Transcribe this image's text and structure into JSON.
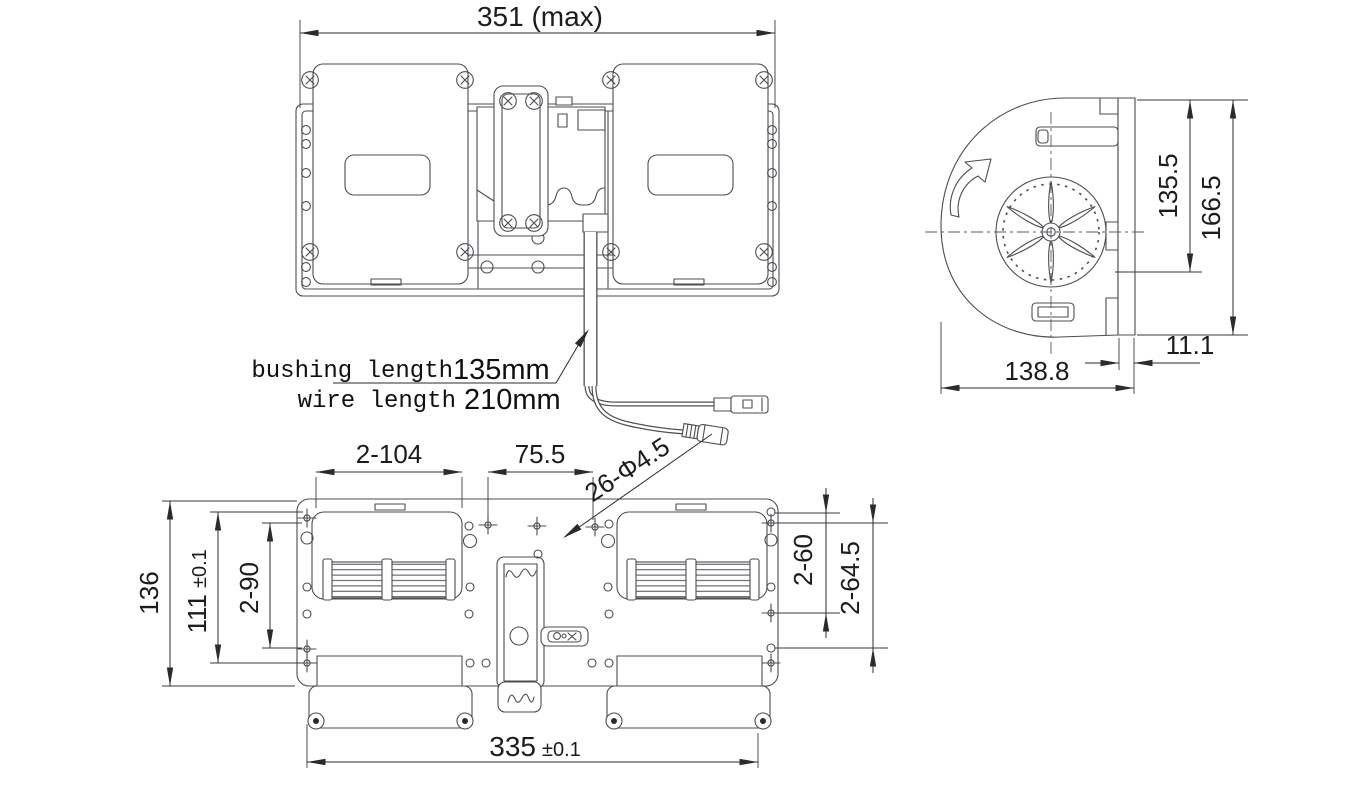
{
  "drawing_type": "engineering-dimension-drawing",
  "subject": "dual-blower-assembly-three-views",
  "colors": {
    "background": "#ffffff",
    "geometry_line": "#4c4c52",
    "dimension_line": "#2b2b2b",
    "text_ink": "#1c1c1c"
  },
  "front_view": {
    "dim_width": "351 (max)"
  },
  "side_view": {
    "dim_inner_height": "135.5",
    "dim_overall_height": "166.5",
    "dim_flange": "11.1",
    "dim_width": "138.8"
  },
  "bottom_view": {
    "dim_opening_width": "2-104",
    "dim_hole_spacing": "75.5",
    "dim_holes_note": "26-Φ4.5",
    "dim_right_inner": "2-60",
    "dim_right_outer": "2-64.5",
    "dim_height": "136",
    "dim_mid_value": "111",
    "dim_mid_tol": "±0.1",
    "dim_left_inner": "2-90",
    "dim_width_value": "335",
    "dim_width_tol": "±0.1"
  },
  "annotations": {
    "bushing_label": "bushing length",
    "bushing_value": "135mm",
    "wire_label": "wire length",
    "wire_value": "210mm"
  }
}
